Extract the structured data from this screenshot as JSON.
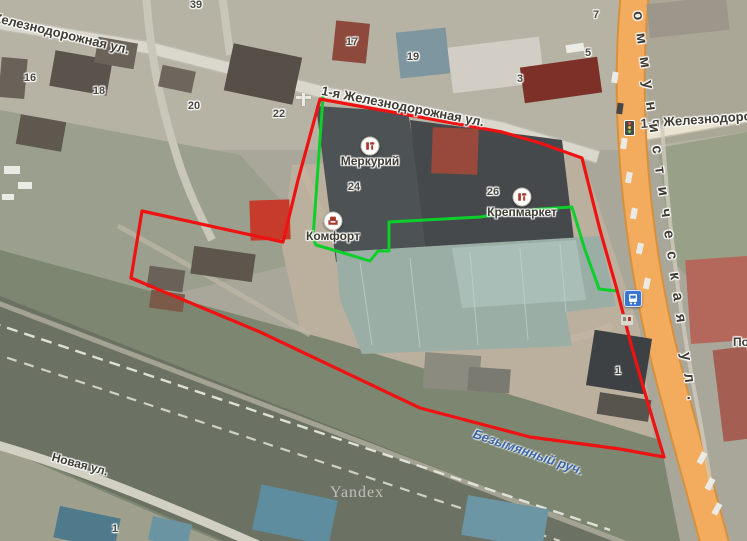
{
  "map": {
    "watermark": "Yandex",
    "colors": {
      "boundary_red": "#ee1212",
      "boundary_green": "#0ccf2a",
      "stream_label": "#3a66a8",
      "road_orange": "#f3ab5e",
      "road_orange_casing": "#d6913f",
      "bus_icon_bg": "#3a76cf",
      "poi_icon": "#a9392d"
    },
    "street_labels": [
      {
        "text": "Железнодорожная ул.",
        "x": -8,
        "y": 9,
        "rotate": 13.5,
        "size": 13
      },
      {
        "text": "1-я Железнодорожная ул.",
        "x": 323,
        "y": 83,
        "rotate": 11,
        "size": 13
      },
      {
        "text": "1-я Железнодорожная ул.",
        "x": 640,
        "y": 116,
        "rotate": -4,
        "size": 13
      },
      {
        "text": "Коммунистическая ул.",
        "x": 643,
        "y": -12,
        "rotate": 82,
        "size": 15,
        "spacing": 13
      },
      {
        "text": "Безымянный руч.",
        "x": 476,
        "y": 426,
        "rotate": 19,
        "size": 13,
        "kind": "stream"
      },
      {
        "text": "Новая ул.",
        "x": 54,
        "y": 450,
        "rotate": 15,
        "size": 12
      },
      {
        "text": "По",
        "x": 733,
        "y": 335,
        "rotate": 0,
        "size": 12
      }
    ],
    "house_numbers": [
      {
        "value": "39",
        "x": 196,
        "y": 5
      },
      {
        "value": "16",
        "x": 30,
        "y": 78
      },
      {
        "value": "18",
        "x": 99,
        "y": 91
      },
      {
        "value": "20",
        "x": 194,
        "y": 106
      },
      {
        "value": "22",
        "x": 279,
        "y": 114
      },
      {
        "value": "17",
        "x": 352,
        "y": 42
      },
      {
        "value": "19",
        "x": 413,
        "y": 57
      },
      {
        "value": "3",
        "x": 520,
        "y": 79
      },
      {
        "value": "5",
        "x": 588,
        "y": 53
      },
      {
        "value": "7",
        "x": 596,
        "y": 15
      },
      {
        "value": "24",
        "x": 354,
        "y": 187
      },
      {
        "value": "26",
        "x": 493,
        "y": 192
      },
      {
        "value": "1",
        "x": 618,
        "y": 371
      },
      {
        "value": "1",
        "x": 115,
        "y": 529
      }
    ],
    "poi": [
      {
        "label": "Меркурий",
        "icon": "furniture-icon",
        "x": 370,
        "y": 146
      },
      {
        "label": "Комфорт",
        "icon": "armchair-icon",
        "x": 333,
        "y": 221
      },
      {
        "label": "Крепмаркет",
        "icon": "furniture-icon",
        "x": 522,
        "y": 197
      }
    ]
  }
}
